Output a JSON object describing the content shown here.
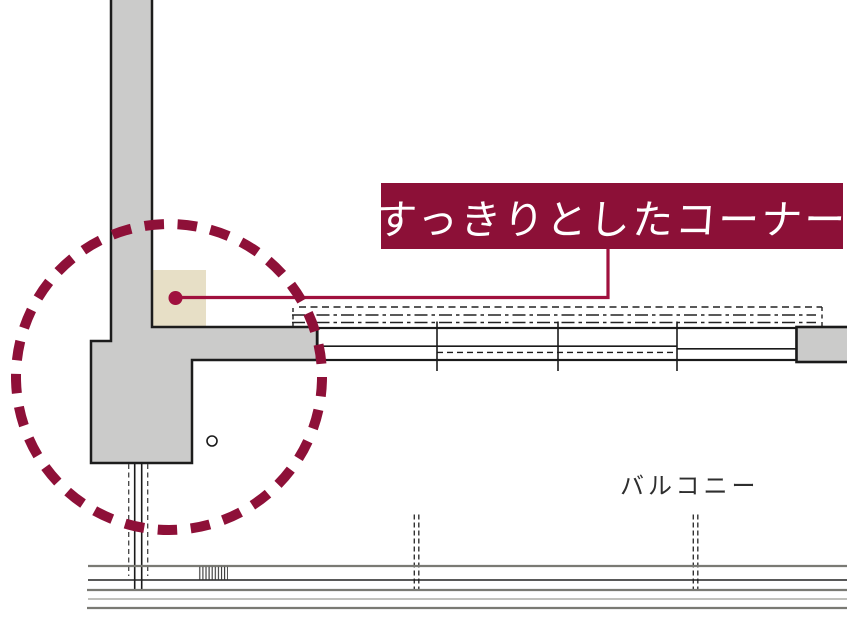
{
  "diagram": {
    "type": "architectural floor plan corner detail",
    "callout": {
      "label": "すっきりとしたコーナー",
      "bg_color": "#8C1037",
      "text_color": "#FFFFFF"
    },
    "area_label": "バルコニー",
    "colors": {
      "accent_burgundy": "#8C1037",
      "leader_red": "#A0103E",
      "wall_fill_gray": "#CBCBCA",
      "wall_outline": "#1C1C1C",
      "corner_highlight_beige": "#E7DFC6",
      "railing_gray": "#7A7A74"
    },
    "markers": {
      "highlight_circle": "dashed-circle-around-corner",
      "leader_dot": "filled-dot-on-corner"
    }
  }
}
